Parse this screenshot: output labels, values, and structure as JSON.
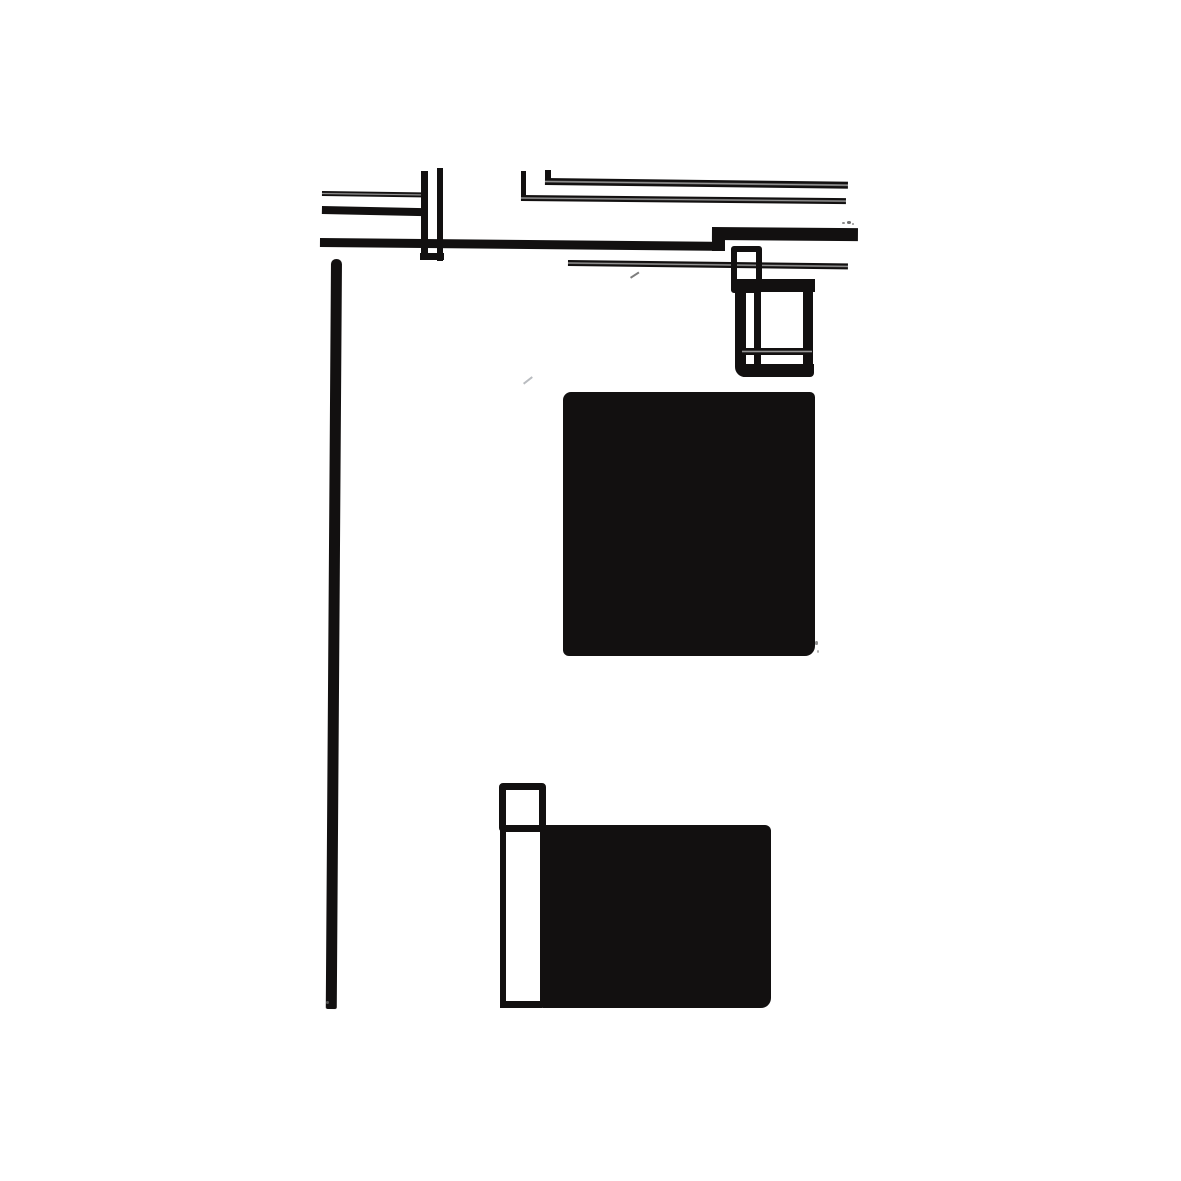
{
  "artwork": {
    "title": "abstract-ink-composition",
    "background": "#ffffff",
    "ink": "#121010",
    "double_stroke_gap": "#969696",
    "canvas": {
      "width": 1181,
      "height": 1181
    },
    "shapes": [
      {
        "name": "thin-line-top-left",
        "type": "rect",
        "x": 322,
        "y": 191,
        "w": 104,
        "h": 5,
        "rot": 0.8,
        "double": true
      },
      {
        "name": "mid-line-top-left",
        "type": "rect",
        "x": 322,
        "y": 206,
        "w": 100,
        "h": 8,
        "rot": 1.2
      },
      {
        "name": "u-left-vertical",
        "type": "rect",
        "x": 421,
        "y": 171,
        "w": 7,
        "h": 89
      },
      {
        "name": "u-right-vertical",
        "type": "rect",
        "x": 437,
        "y": 168,
        "w": 6,
        "h": 93
      },
      {
        "name": "u-bottom-joint",
        "type": "rect",
        "x": 420,
        "y": 253,
        "w": 24,
        "h": 7
      },
      {
        "name": "main-rule-left",
        "type": "rect",
        "x": 320,
        "y": 238,
        "w": 400,
        "h": 9,
        "rot": 0.55
      },
      {
        "name": "main-rule-step",
        "type": "rect",
        "x": 712,
        "y": 228,
        "w": 13,
        "h": 23
      },
      {
        "name": "main-rule-right",
        "type": "rect",
        "x": 712,
        "y": 227,
        "w": 146,
        "h": 13,
        "rot": 0.45
      },
      {
        "name": "upper-right-line-riser",
        "type": "rect",
        "x": 545,
        "y": 170,
        "w": 6,
        "h": 15
      },
      {
        "name": "upper-right-line",
        "type": "rect",
        "x": 545,
        "y": 178,
        "w": 303,
        "h": 7,
        "rot": 0.7,
        "double": true
      },
      {
        "name": "second-right-line-riser",
        "type": "rect",
        "x": 521,
        "y": 171,
        "w": 5,
        "h": 27
      },
      {
        "name": "second-right-line",
        "type": "rect",
        "x": 521,
        "y": 195,
        "w": 325,
        "h": 6,
        "rot": 0.55,
        "double": true
      },
      {
        "name": "lower-thin-line",
        "type": "rect",
        "x": 568,
        "y": 260,
        "w": 280,
        "h": 6,
        "rot": 0.7,
        "double": true
      },
      {
        "name": "frame-small-rect",
        "type": "outline",
        "x": 731,
        "y": 246,
        "w": 31,
        "h": 47,
        "border": 6,
        "radius": "3px"
      },
      {
        "name": "frame-inner-vertical",
        "type": "rect",
        "x": 754,
        "y": 291,
        "w": 7,
        "h": 83
      },
      {
        "name": "frame-top-edge",
        "type": "rect",
        "x": 735,
        "y": 279,
        "w": 80,
        "h": 13
      },
      {
        "name": "frame-corner-flare",
        "type": "triangle",
        "x": 793,
        "y": 270,
        "w": 23,
        "h": 22
      },
      {
        "name": "frame-left-edge",
        "type": "rect",
        "x": 735,
        "y": 285,
        "w": 11,
        "h": 92,
        "radius": "0 0 0 10px"
      },
      {
        "name": "frame-bottom-edge",
        "type": "rect",
        "x": 737,
        "y": 364,
        "w": 77,
        "h": 13,
        "radius": "0 0 4px 8px"
      },
      {
        "name": "frame-right-edge",
        "type": "rect",
        "x": 803,
        "y": 287,
        "w": 10,
        "h": 80
      },
      {
        "name": "frame-inner-horizontal",
        "type": "rect",
        "x": 742,
        "y": 348,
        "w": 70,
        "h": 7,
        "double": true
      },
      {
        "name": "black-square",
        "type": "rect",
        "x": 563,
        "y": 392,
        "w": 252,
        "h": 264,
        "radius": "8px 5px 10px 6px"
      },
      {
        "name": "long-vertical-stroke",
        "type": "rect",
        "x": 331,
        "y": 259,
        "w": 11,
        "h": 750,
        "rot": 0.4,
        "radius": "5px 5px 2px 2px"
      },
      {
        "name": "bottom-small-square",
        "type": "outline",
        "x": 499,
        "y": 783,
        "w": 47,
        "h": 49,
        "border": 7,
        "radius": "4px"
      },
      {
        "name": "bottom-strip-left-edge",
        "type": "rect",
        "x": 500,
        "y": 828,
        "w": 6,
        "h": 180
      },
      {
        "name": "bottom-strip-bottom-edge",
        "type": "rect",
        "x": 500,
        "y": 1001,
        "w": 42,
        "h": 7
      },
      {
        "name": "bottom-black-rectangle",
        "type": "rect",
        "x": 540,
        "y": 825,
        "w": 231,
        "h": 183,
        "radius": "3px 6px 10px 3px"
      },
      {
        "name": "ink-speck",
        "type": "speck",
        "x": 842,
        "y": 222,
        "w": 3,
        "h": 2,
        "color": "#8a8a8a"
      },
      {
        "name": "ink-speck",
        "type": "speck",
        "x": 847,
        "y": 221,
        "w": 4,
        "h": 3,
        "color": "#6f6f6f"
      },
      {
        "name": "ink-speck",
        "type": "speck",
        "x": 852,
        "y": 223,
        "w": 2,
        "h": 2,
        "color": "#9a9a9a"
      },
      {
        "name": "stray-tick",
        "type": "rect",
        "x": 523,
        "y": 383,
        "w": 11,
        "h": 2,
        "rot": -38,
        "color": "#b9bcc0"
      },
      {
        "name": "stray-tick",
        "type": "rect",
        "x": 630,
        "y": 277,
        "w": 10,
        "h": 2,
        "rot": -33,
        "color": "#7d7d7d"
      },
      {
        "name": "ink-speck",
        "type": "speck",
        "x": 815,
        "y": 641,
        "w": 3,
        "h": 4,
        "color": "#8f8f8f"
      },
      {
        "name": "ink-speck",
        "type": "speck",
        "x": 817,
        "y": 650,
        "w": 2,
        "h": 3,
        "color": "#b0b0b0"
      },
      {
        "name": "ink-speck",
        "type": "speck",
        "x": 326,
        "y": 1001,
        "w": 3,
        "h": 3,
        "color": "#555555"
      }
    ]
  }
}
